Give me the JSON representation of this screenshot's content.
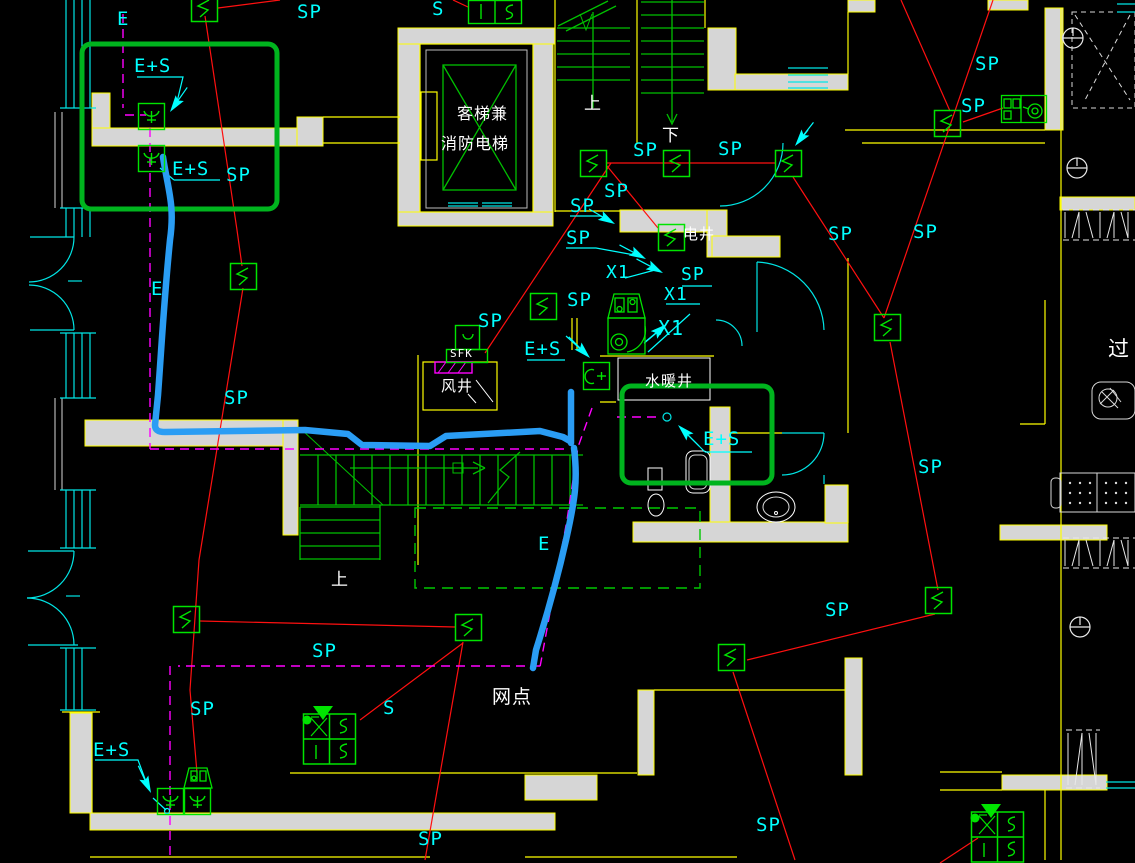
{
  "drawing_type": "CAD floor plan - fire alarm / electrical layout",
  "colors": {
    "background": "#000000",
    "wall_fill": "#d6d6d6",
    "wall_edge": "#ffff00",
    "annotation_cyan": "#00ffff",
    "architecture_green": "#00c000",
    "device_green": "#00e400",
    "highlight_green": "#00b41e",
    "wiring_red": "#ff1010",
    "circuit_magenta": "#ff00ff",
    "freehand_blue": "#2a9df4",
    "text_white": "#ffffff"
  },
  "annotations": [
    {
      "name": "label-e-topleft",
      "text": "E",
      "x": 117,
      "y": 10,
      "color": "#00ffff",
      "size": 19
    },
    {
      "name": "label-es-1",
      "text": "E+S",
      "x": 134,
      "y": 57,
      "color": "#00ffff",
      "size": 19
    },
    {
      "name": "label-es-2",
      "text": "E+S",
      "x": 172,
      "y": 160,
      "color": "#00ffff",
      "size": 19
    },
    {
      "name": "label-sp-1",
      "text": "SP",
      "x": 226,
      "y": 166,
      "color": "#00ffff",
      "size": 19
    },
    {
      "name": "label-sp-2",
      "text": "SP",
      "x": 297,
      "y": 3,
      "color": "#00ffff",
      "size": 19
    },
    {
      "name": "label-s-1",
      "text": "S",
      "x": 432,
      "y": 0,
      "color": "#00ffff",
      "size": 19
    },
    {
      "name": "label-sp-3",
      "text": "SP",
      "x": 633,
      "y": 141,
      "color": "#00ffff",
      "size": 19
    },
    {
      "name": "label-sp-4",
      "text": "SP",
      "x": 718,
      "y": 140,
      "color": "#00ffff",
      "size": 19
    },
    {
      "name": "label-sp-5",
      "text": "SP",
      "x": 604,
      "y": 182,
      "color": "#00ffff",
      "size": 19
    },
    {
      "name": "label-sp-6",
      "text": "SP",
      "x": 570,
      "y": 197,
      "color": "#00ffff",
      "size": 19
    },
    {
      "name": "label-sp-7",
      "text": "SP",
      "x": 566,
      "y": 229,
      "color": "#00ffff",
      "size": 19
    },
    {
      "name": "label-x1-1",
      "text": "X1",
      "x": 606,
      "y": 264,
      "color": "#00ffff",
      "size": 18
    },
    {
      "name": "label-sp-8",
      "text": "SP",
      "x": 567,
      "y": 291,
      "color": "#00ffff",
      "size": 19
    },
    {
      "name": "label-sp-9",
      "text": "SP",
      "x": 681,
      "y": 266,
      "color": "#00ffff",
      "size": 18
    },
    {
      "name": "label-x1-2",
      "text": "X1",
      "x": 664,
      "y": 286,
      "color": "#00ffff",
      "size": 18
    },
    {
      "name": "label-x1-3",
      "text": "X1",
      "x": 658,
      "y": 318,
      "color": "#00ffff",
      "size": 20
    },
    {
      "name": "label-sp-10",
      "text": "SP",
      "x": 478,
      "y": 312,
      "color": "#00ffff",
      "size": 19
    },
    {
      "name": "label-es-3",
      "text": "E+S",
      "x": 524,
      "y": 340,
      "color": "#00ffff",
      "size": 19
    },
    {
      "name": "label-es-4",
      "text": "E+S",
      "x": 703,
      "y": 430,
      "color": "#00ffff",
      "size": 19
    },
    {
      "name": "label-sp-11",
      "text": "SP",
      "x": 975,
      "y": 55,
      "color": "#00ffff",
      "size": 19
    },
    {
      "name": "label-sp-12",
      "text": "SP",
      "x": 961,
      "y": 97,
      "color": "#00ffff",
      "size": 19
    },
    {
      "name": "label-sp-13",
      "text": "SP",
      "x": 828,
      "y": 225,
      "color": "#00ffff",
      "size": 19
    },
    {
      "name": "label-sp-14",
      "text": "SP",
      "x": 913,
      "y": 223,
      "color": "#00ffff",
      "size": 19
    },
    {
      "name": "label-sp-15",
      "text": "SP",
      "x": 918,
      "y": 458,
      "color": "#00ffff",
      "size": 19
    },
    {
      "name": "label-sp-16",
      "text": "SP",
      "x": 825,
      "y": 601,
      "color": "#00ffff",
      "size": 19
    },
    {
      "name": "label-sp-17",
      "text": "SP",
      "x": 224,
      "y": 389,
      "color": "#00ffff",
      "size": 19
    },
    {
      "name": "label-e-left",
      "text": "E",
      "x": 151,
      "y": 280,
      "color": "#00ffff",
      "size": 19
    },
    {
      "name": "label-sp-18",
      "text": "SP",
      "x": 312,
      "y": 642,
      "color": "#00ffff",
      "size": 19
    },
    {
      "name": "label-s-2",
      "text": "S",
      "x": 383,
      "y": 699,
      "color": "#00ffff",
      "size": 19
    },
    {
      "name": "label-sp-19",
      "text": "SP",
      "x": 190,
      "y": 700,
      "color": "#00ffff",
      "size": 19
    },
    {
      "name": "label-es-5",
      "text": "E+S",
      "x": 93,
      "y": 741,
      "color": "#00ffff",
      "size": 19
    },
    {
      "name": "label-e-mid",
      "text": "E",
      "x": 538,
      "y": 535,
      "color": "#00ffff",
      "size": 19
    },
    {
      "name": "label-sp-20",
      "text": "SP",
      "x": 418,
      "y": 830,
      "color": "#00ffff",
      "size": 19
    },
    {
      "name": "label-sp-21",
      "text": "SP",
      "x": 756,
      "y": 816,
      "color": "#00ffff",
      "size": 19
    },
    {
      "name": "label-elevator-1",
      "text": "客梯兼",
      "x": 457,
      "y": 106,
      "color": "#ffffff",
      "size": 16
    },
    {
      "name": "label-elevator-2",
      "text": "消防电梯",
      "x": 441,
      "y": 136,
      "color": "#ffffff",
      "size": 16
    },
    {
      "name": "label-stair-up-1",
      "text": "上",
      "x": 584,
      "y": 96,
      "color": "#ffffff",
      "size": 17
    },
    {
      "name": "label-stair-down-1",
      "text": "下",
      "x": 662,
      "y": 128,
      "color": "#ffffff",
      "size": 17
    },
    {
      "name": "label-shaft-electric",
      "text": "电井",
      "x": 683,
      "y": 227,
      "color": "#ffffff",
      "size": 15
    },
    {
      "name": "label-sfk",
      "text": "SFK",
      "x": 450,
      "y": 348,
      "color": "#ffffff",
      "size": 11
    },
    {
      "name": "label-shaft-air",
      "text": "风井",
      "x": 441,
      "y": 379,
      "color": "#ffffff",
      "size": 15
    },
    {
      "name": "label-shaft-plumbing",
      "text": "水暖井",
      "x": 645,
      "y": 374,
      "color": "#ffffff",
      "size": 15
    },
    {
      "name": "label-stair-up-2",
      "text": "上",
      "x": 331,
      "y": 572,
      "color": "#ffffff",
      "size": 17
    },
    {
      "name": "label-network-point",
      "text": "网点",
      "x": 492,
      "y": 688,
      "color": "#ffffff",
      "size": 19
    },
    {
      "name": "label-corridor",
      "text": "过",
      "x": 1108,
      "y": 339,
      "color": "#ffffff",
      "size": 21
    }
  ],
  "devices": [
    {
      "name": "speaker-box-1",
      "type": "speaker",
      "x": 191,
      "y": -5
    },
    {
      "name": "speaker-box-2",
      "type": "speaker",
      "x": 230,
      "y": 263
    },
    {
      "name": "speaker-box-3",
      "type": "speaker",
      "x": 580,
      "y": 150
    },
    {
      "name": "speaker-box-4",
      "type": "speaker",
      "x": 663,
      "y": 150
    },
    {
      "name": "speaker-box-5",
      "type": "speaker",
      "x": 775,
      "y": 150
    },
    {
      "name": "speaker-box-6",
      "type": "speaker",
      "x": 658,
      "y": 224
    },
    {
      "name": "speaker-box-7",
      "type": "speaker",
      "x": 530,
      "y": 293
    },
    {
      "name": "speaker-box-8",
      "type": "speaker",
      "x": 934,
      "y": 110
    },
    {
      "name": "speaker-box-9",
      "type": "speaker",
      "x": 874,
      "y": 314
    },
    {
      "name": "speaker-box-10",
      "type": "speaker",
      "x": 173,
      "y": 606
    },
    {
      "name": "speaker-box-11",
      "type": "speaker",
      "x": 455,
      "y": 614
    },
    {
      "name": "speaker-box-12",
      "type": "speaker",
      "x": 718,
      "y": 644
    },
    {
      "name": "speaker-box-13",
      "type": "speaker",
      "x": 925,
      "y": 587
    },
    {
      "name": "es-detector-1",
      "type": "esdev",
      "x": 138,
      "y": 103
    },
    {
      "name": "es-detector-2",
      "type": "esdev",
      "x": 138,
      "y": 145
    },
    {
      "name": "es-detector-3",
      "type": "esdev",
      "x": 157,
      "y": 788
    },
    {
      "name": "es-detector-4",
      "type": "esdev",
      "x": 184,
      "y": 788
    },
    {
      "name": "es-detector-5",
      "type": "esdevb",
      "x": 583,
      "y": 362
    },
    {
      "name": "wc-appliance",
      "type": "appliance",
      "x": 605,
      "y": 292
    },
    {
      "name": "wc-appliance-small",
      "type": "appliancesm",
      "x": 183,
      "y": 766
    },
    {
      "name": "detector-unit",
      "type": "detector",
      "x": 1001,
      "y": 93
    },
    {
      "name": "hydrant-panel-1",
      "type": "hydrant",
      "x": 303,
      "y": 700
    },
    {
      "name": "hydrant-panel-2",
      "type": "hydrant",
      "x": 971,
      "y": 798
    },
    {
      "name": "alarm-bell-box",
      "type": "bell",
      "x": 468,
      "y": 0
    },
    {
      "name": "sfk-fan-unit",
      "type": "fan",
      "x": 446,
      "y": 325
    },
    {
      "name": "ceiling-light-1",
      "type": "light",
      "x": 1073,
      "y": 38
    },
    {
      "name": "ceiling-light-2",
      "type": "light",
      "x": 1077,
      "y": 168
    },
    {
      "name": "ceiling-light-3",
      "type": "light",
      "x": 1080,
      "y": 627
    }
  ]
}
